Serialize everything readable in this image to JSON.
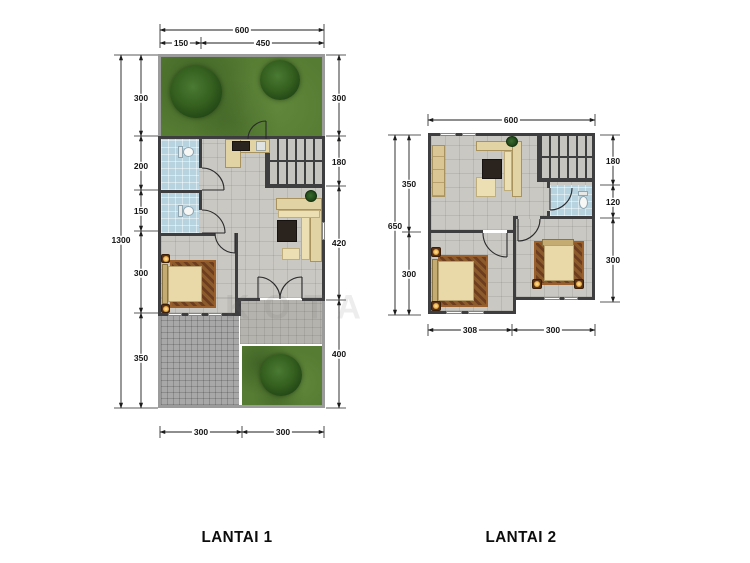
{
  "titles": {
    "floor1": "LANTAI 1",
    "floor2": "LANTAI 2"
  },
  "watermark": "KOTA",
  "floor1": {
    "dims": {
      "top_total": "600",
      "top_sub": [
        "150",
        "450"
      ],
      "left_total": "1300",
      "left_segs": [
        "300",
        "200",
        "150",
        "300",
        "350"
      ],
      "right_segs": [
        "300",
        "180",
        "420",
        "400"
      ],
      "bottom_segs": [
        "300",
        "300"
      ]
    }
  },
  "floor2": {
    "dims": {
      "top_total": "600",
      "left_total": "650",
      "left_segs": [
        "350",
        "300"
      ],
      "right_segs": [
        "180",
        "120",
        "300"
      ],
      "bottom_segs": [
        "308",
        "300"
      ]
    }
  },
  "colors": {
    "wall": "#3e3e40",
    "plot_border": "#9b9b9b",
    "grass": "#567c33",
    "floor_tile": "#cac8c2",
    "bathroom": "#b7d3e0",
    "terrace_paving": "#b5b3ad",
    "carport_paving": "#a8a8a8",
    "furniture_beige": "#e2d3a4",
    "rug": "#6d3d20",
    "dimension_text": "#141414"
  }
}
